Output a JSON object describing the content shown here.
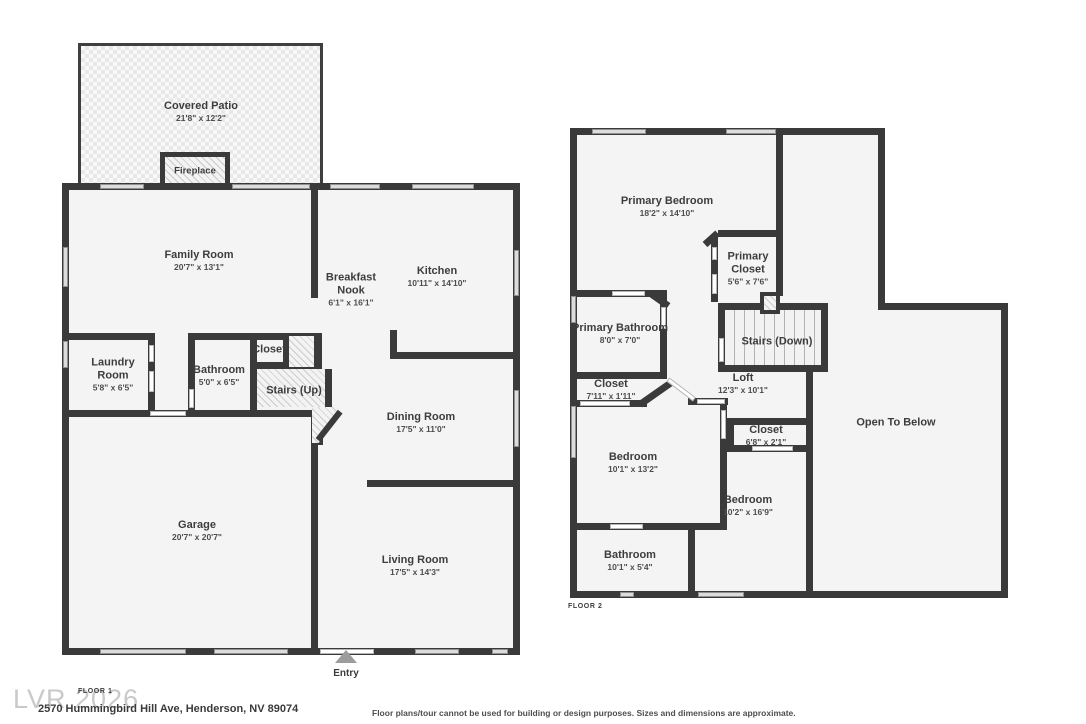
{
  "floor1": {
    "label": "FLOOR 1",
    "rooms": {
      "covered_patio": {
        "name": "Covered Patio",
        "dims": "21'8\" x 12'2\""
      },
      "fireplace": {
        "name": "Fireplace"
      },
      "family_room": {
        "name": "Family Room",
        "dims": "20'7\" x 13'1\""
      },
      "breakfast_nook": {
        "name": "Breakfast Nook",
        "dims": "6'1\" x 16'1\""
      },
      "kitchen": {
        "name": "Kitchen",
        "dims": "10'11\" x 14'10\""
      },
      "laundry_room": {
        "name": "Laundry Room",
        "dims": "5'8\" x 6'5\""
      },
      "bathroom": {
        "name": "Bathroom",
        "dims": "5'0\" x 6'5\""
      },
      "closet": {
        "name": "Closet"
      },
      "stairs_up": {
        "name": "Stairs (Up)"
      },
      "dining_room": {
        "name": "Dining Room",
        "dims": "17'5\" x 11'0\""
      },
      "garage": {
        "name": "Garage",
        "dims": "20'7\" x 20'7\""
      },
      "living_room": {
        "name": "Living Room",
        "dims": "17'5\" x 14'3\""
      },
      "entry": {
        "name": "Entry"
      }
    }
  },
  "floor2": {
    "label": "FLOOR 2",
    "rooms": {
      "primary_bedroom": {
        "name": "Primary Bedroom",
        "dims": "18'2\" x 14'10\""
      },
      "primary_closet": {
        "name": "Primary Closet",
        "dims": "5'6\" x 7'6\""
      },
      "primary_bathroom": {
        "name": "Primary Bathroom",
        "dims": "8'0\" x 7'0\""
      },
      "stairs_down": {
        "name": "Stairs (Down)"
      },
      "closet_hall": {
        "name": "Closet",
        "dims": "7'11\" x 1'11\""
      },
      "loft": {
        "name": "Loft",
        "dims": "12'3\" x 10'1\""
      },
      "closet_bedroom": {
        "name": "Closet",
        "dims": "6'8\" x 2'1\""
      },
      "bedroom_left": {
        "name": "Bedroom",
        "dims": "10'1\" x 13'2\""
      },
      "bedroom_right": {
        "name": "Bedroom",
        "dims": "10'2\" x 16'9\""
      },
      "open_to_below": {
        "name": "Open To Below"
      },
      "bathroom": {
        "name": "Bathroom",
        "dims": "10'1\" x 5'4\""
      }
    }
  },
  "footer": {
    "watermark": "LVR 2026",
    "address": "2570 Hummingbird Hill Ave, Henderson, NV 89074",
    "disclaimer": "Floor plans/tour cannot be used for building or design purposes. Sizes and dimensions are approximate."
  },
  "colors": {
    "wall": "#3a3a3a",
    "room_fill": "#f4f4f4",
    "window": "#dcdcdc",
    "entry_arrow": "#9c9c9c"
  }
}
